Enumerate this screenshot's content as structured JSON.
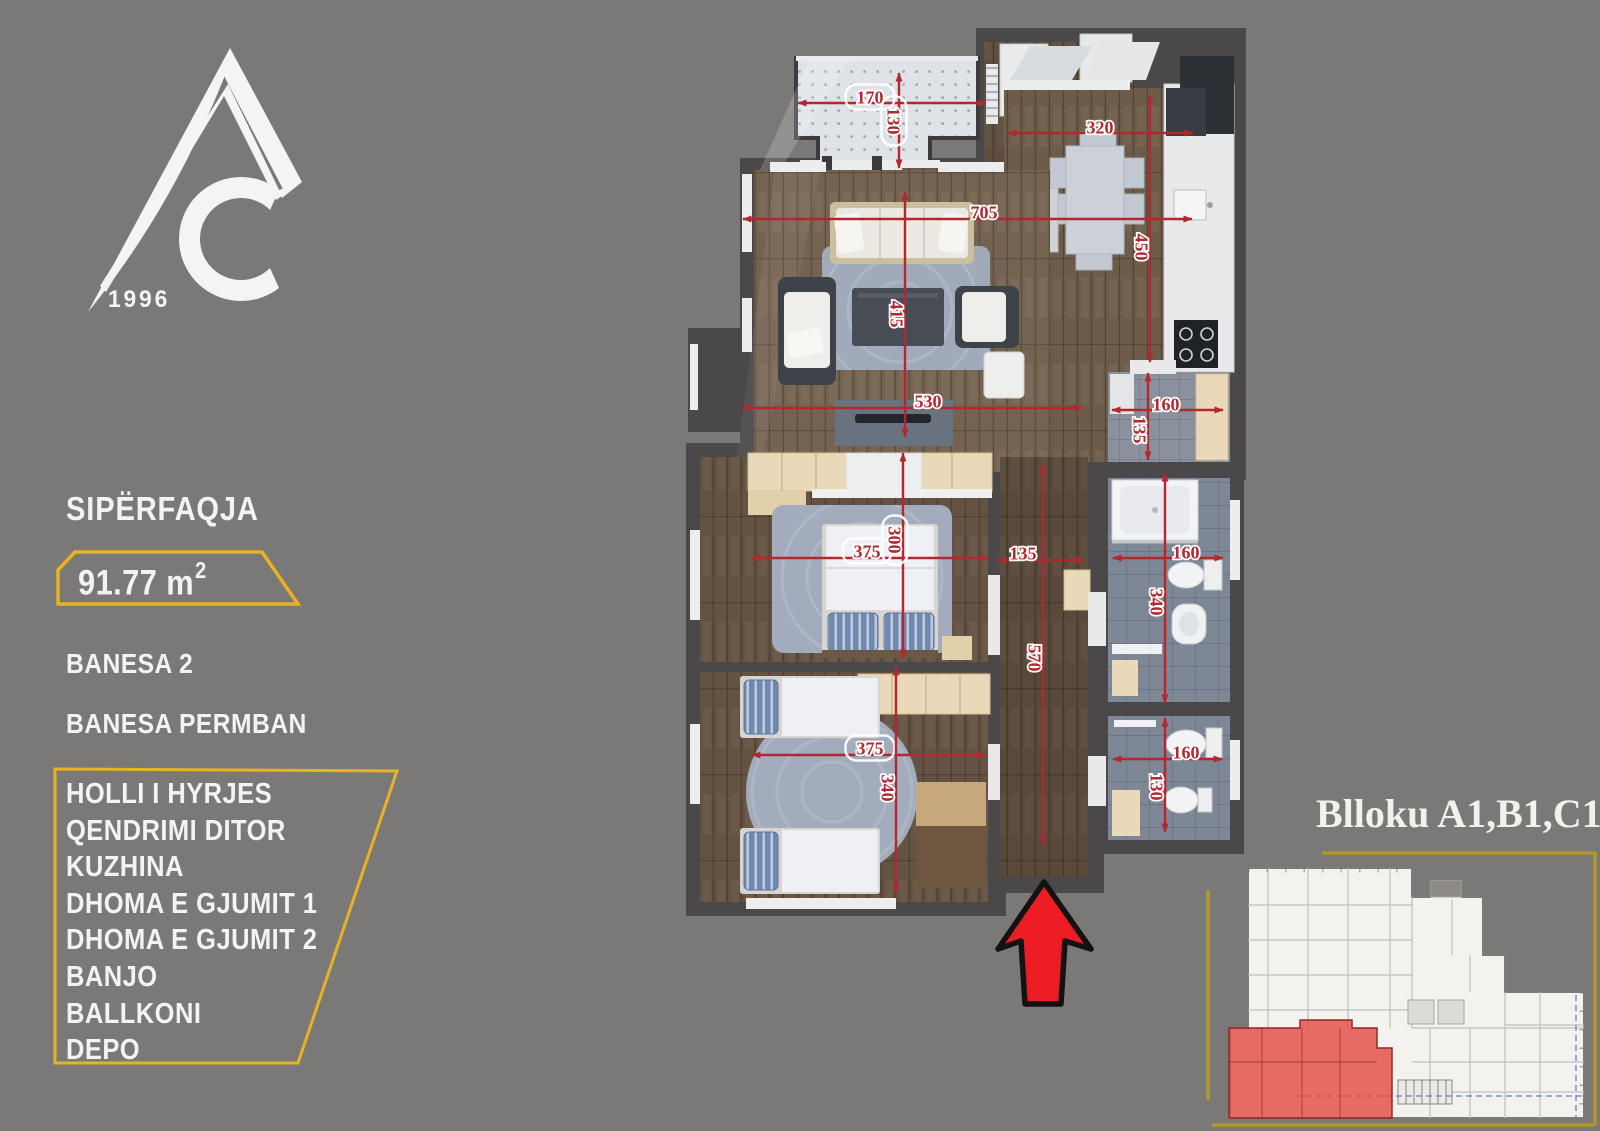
{
  "colors": {
    "background": "#7b7978",
    "wall": "#4a4848",
    "accent_yellow": "#e7b223",
    "frame_yellow": "#b2962e",
    "dimension_red": "#b3282e",
    "arrow_red": "#ec1c24",
    "highlight_red": "#e2403a",
    "text_white": "#f4f3f1"
  },
  "logo": {
    "year": "1996"
  },
  "sidebar": {
    "surface_label": "SIPËRFAQJA",
    "surface_value": "91.77 m",
    "surface_exponent": "2",
    "unit_name": "BANESA 2",
    "contains_label": "BANESA PERMBAN",
    "rooms": [
      "HOLLI I HYRJES",
      "QENDRIMI DITOR",
      "KUZHINA",
      "DHOMA E GJUMIT 1",
      "DHOMA E GJUMIT 2",
      "BANJO",
      "BALLKONI",
      "DEPO"
    ]
  },
  "floor_plan": {
    "dimensions": [
      {
        "id": "balcony-width",
        "value": "170"
      },
      {
        "id": "balcony-depth",
        "value": "130"
      },
      {
        "id": "kitchen-width",
        "value": "320"
      },
      {
        "id": "living-dining-width",
        "value": "705"
      },
      {
        "id": "kitchen-depth",
        "value": "450"
      },
      {
        "id": "living-depth",
        "value": "415"
      },
      {
        "id": "living-width",
        "value": "530"
      },
      {
        "id": "depo-width",
        "value": "160"
      },
      {
        "id": "depo-depth",
        "value": "135"
      },
      {
        "id": "bedroom1-width",
        "value": "375"
      },
      {
        "id": "bedroom1-depth",
        "value": "300"
      },
      {
        "id": "hall-width",
        "value": "135"
      },
      {
        "id": "hall-depth",
        "value": "570"
      },
      {
        "id": "bathroom-width",
        "value": "160"
      },
      {
        "id": "bathroom-depth",
        "value": "340"
      },
      {
        "id": "bedroom2-width",
        "value": "375"
      },
      {
        "id": "bedroom2-depth",
        "value": "340"
      },
      {
        "id": "wc-width",
        "value": "160"
      },
      {
        "id": "wc-depth",
        "value": "130"
      }
    ]
  },
  "block_plan": {
    "title": "Blloku A1,B1,C1"
  }
}
